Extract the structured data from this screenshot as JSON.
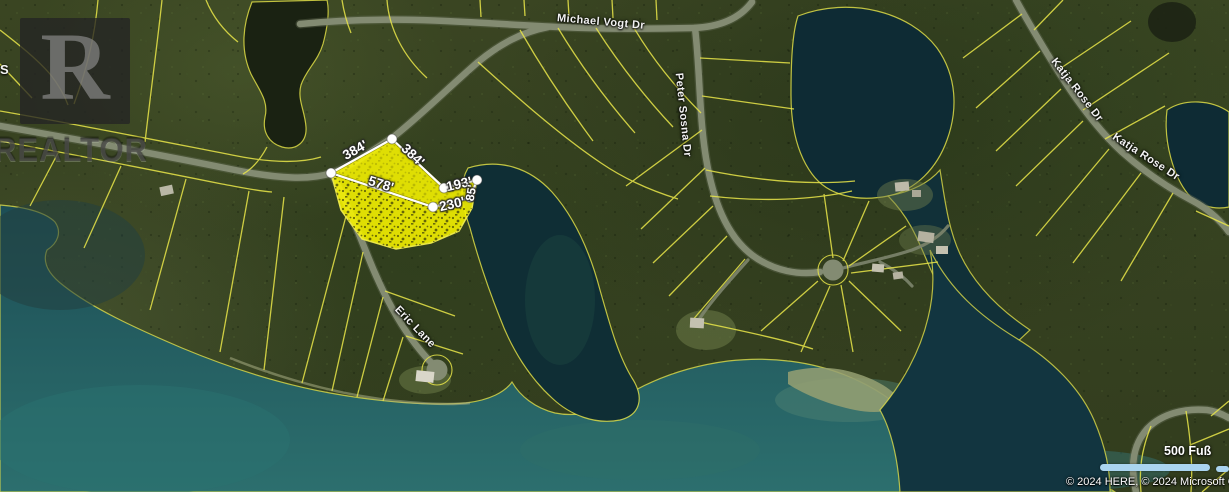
{
  "map": {
    "streets": {
      "michael_vogt": "Michael Vogt Dr",
      "peter_sosna": "Peter Sosna Dr",
      "katja_rose_upper": "Katja Rose Dr",
      "katja_rose_lower": "Katja Rose Dr",
      "eric_lane": "Eric Lane",
      "left_edge_fragment": "S"
    },
    "parcel": {
      "dims": {
        "side_nw": "384'",
        "side_ne": "384'",
        "side_long": "578'",
        "side_right_upper": "193'",
        "side_right_lower": "230'",
        "side_shore": "85'"
      }
    },
    "scale": {
      "label": "500 Fuß"
    },
    "attribution": "© 2024 HERE, © 2024 Microsoft Corporation",
    "watermark": {
      "letter": "R",
      "word": "REALTOR"
    },
    "colors": {
      "parcel_line": "#e9e649",
      "highlight_fill": "#f7f400",
      "measure_line": "#ffffff",
      "scalebar": "#aad4ef",
      "water_deep": "#0e2b34",
      "water_teal": "#2c6f6e",
      "road": "#838b72"
    }
  }
}
